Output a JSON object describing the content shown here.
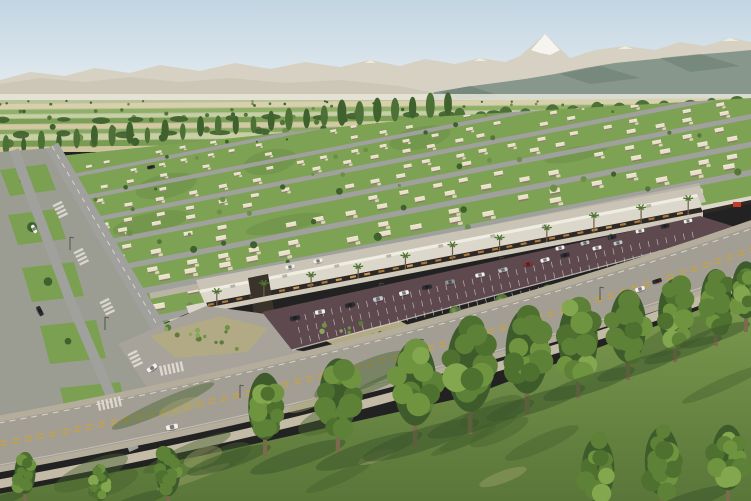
{
  "scene_type": "aerial-render-of-residential-development-with-retail-strip",
  "palette": {
    "sky_top": "#c2d5e2",
    "sky_bottom": "#eaeff2",
    "mountain_far": "#d7d1c3",
    "snow": "#f6f4ef",
    "mountain_right": "#87978b",
    "mountain_right_dark": "#64766a",
    "hills_left": "#cdc7b7",
    "haze": "#e6e6da",
    "farm_base": "#bac29a",
    "farm_s1": "#d8cfac",
    "farm_s2": "#8fb066",
    "farm_s3": "#c6d0a6",
    "farm_s4": "#7d9e55",
    "farm_s5": "#d3c8a2",
    "farm_s6": "#8aa862",
    "farm_s7": "#c9cfa4",
    "farm_s8": "#7a9b52",
    "farm_s9": "#cfc49e",
    "tree_dark": "#3f612e",
    "tree_mid": "#557539",
    "tree_light": "#6e8f49",
    "lawn": "#7da254",
    "lawn_dark": "#5d8140",
    "street": "#a0a09c",
    "house_wall": "#e9e0c8",
    "house_shade": "#7b7260",
    "house_top": "#f3ecd9",
    "house_wing": "#ddd3b9",
    "alley": "#b9b4a6",
    "roof_rear": "#c9c4b6",
    "roof_main": "#dbd7cb",
    "parapet": "#efece2",
    "canopy": "#2e2925",
    "glow": "#bc7f3e",
    "glow_hi": "#e0a45c",
    "portal": "#3a332b",
    "plaza": "#cfc9ba",
    "paved_west": "#a7a29a",
    "bed": "#b2aa85",
    "shrub1": "#5c7a3b",
    "shrub2": "#6f9148",
    "shrub3": "#87a759",
    "shrub_red": "#b86a38",
    "parking": "#5e4a4e",
    "stall": "#ddd5d8",
    "median": "#b1a989",
    "blvd_shoulder": "#b4ad9c",
    "blvd": "#a39e94",
    "lane_yellow": "#c9a23e",
    "line_white": "#e5e1d8",
    "sidewalk": "#c4bba6",
    "verge": "#9b9d92",
    "verge_green": "#79a04e",
    "grass": "#7d9b50",
    "grass_deep": "#5a7639",
    "grass_dark": "#46612f",
    "grass_light": "#a8a771",
    "fg_dark": "#3e5c2b",
    "fg1": "#4e712f",
    "fg2": "#5d8136",
    "fg3": "#6f9440",
    "fg4": "#82a74e",
    "trunk": "#7c6a4e",
    "shadow": "#3a5429",
    "umbrella": "#e0772e",
    "sign_red": "#c23b2c",
    "pole": "#4a4a48",
    "car_white": "#f1f0ec",
    "car_black": "#2c2c32",
    "car_silver": "#c4c8cc",
    "car_gray": "#8e949a",
    "car_red": "#8e2f2f"
  },
  "counts": {
    "farm_scatter": 85,
    "hedge_row1": 18,
    "hedge_row2": 15,
    "poplars": 26,
    "round_row": 13,
    "grass_mottle": 16,
    "grass_patches": 6,
    "res_tree_step": 30
  },
  "residential": {
    "clip_points": "0,162 445,116 751,98 751,202 205,306 120,342 0,378",
    "street_b": [
      190,
      214,
      238,
      263,
      291,
      319,
      349,
      381,
      415,
      449,
      483
    ],
    "slope": 0.195
  },
  "strip": {
    "front": [
      205,
      303,
      700,
      207
    ],
    "columns": 26,
    "glow_dashes": 34,
    "palms": 11,
    "roof_units": 9
  },
  "parking_cars": [
    [
      295,
      318,
      "car_black"
    ],
    [
      320,
      312,
      "car_white"
    ],
    [
      350,
      305,
      "car_black"
    ],
    [
      378,
      299,
      "car_silver"
    ],
    [
      404,
      293,
      "car_white"
    ],
    [
      427,
      287,
      "car_black"
    ],
    [
      450,
      282,
      "car_gray"
    ],
    [
      480,
      275,
      "car_white"
    ],
    [
      503,
      270,
      "car_silver"
    ],
    [
      528,
      264,
      "car_red"
    ],
    [
      545,
      260,
      "car_white"
    ],
    [
      565,
      255,
      "car_black"
    ],
    [
      597,
      248,
      "car_white"
    ],
    [
      618,
      243,
      "car_silver"
    ],
    [
      560,
      248,
      "car_white"
    ],
    [
      585,
      243,
      "car_silver"
    ],
    [
      612,
      237,
      "car_black"
    ],
    [
      640,
      231,
      "car_white"
    ],
    [
      665,
      226,
      "car_black"
    ],
    [
      688,
      221,
      "car_white"
    ]
  ],
  "vehicles": [
    [
      152,
      368,
      -35,
      "car_white"
    ],
    [
      172,
      427,
      -12,
      "car_white"
    ],
    [
      342,
      367,
      -13,
      "car_black"
    ],
    [
      657,
      281,
      -18,
      "car_black"
    ],
    [
      640,
      289,
      -18,
      "car_white"
    ],
    [
      34,
      229,
      63,
      "car_white"
    ],
    [
      40,
      311,
      63,
      "car_black"
    ],
    [
      151,
      167,
      -12,
      "car_black"
    ],
    [
      290,
      267,
      -12,
      "car_white"
    ],
    [
      318,
      261,
      -12,
      "car_white"
    ]
  ],
  "fg_trees": [
    [
      25,
      504,
      50
    ],
    [
      100,
      510,
      44
    ],
    [
      168,
      508,
      58
    ],
    [
      265,
      456,
      80
    ],
    [
      338,
      452,
      90
    ],
    [
      415,
      446,
      102
    ],
    [
      470,
      434,
      110
    ],
    [
      527,
      414,
      102
    ],
    [
      578,
      398,
      94
    ],
    [
      628,
      380,
      87
    ],
    [
      675,
      362,
      80
    ],
    [
      716,
      346,
      74
    ],
    [
      746,
      332,
      68
    ],
    [
      598,
      518,
      78
    ],
    [
      662,
      512,
      82
    ],
    [
      728,
      506,
      78
    ]
  ],
  "median_trees": [
    [
      455,
      318
    ],
    [
      502,
      307
    ],
    [
      548,
      297
    ],
    [
      594,
      287
    ],
    [
      640,
      276
    ]
  ],
  "umbrellas": [
    [
      193,
      317,
      4
    ],
    [
      205,
      312,
      3.5
    ],
    [
      217,
      319,
      4
    ],
    [
      187,
      324,
      3
    ]
  ],
  "zebras": [
    [
      160,
      371,
      -12,
      6
    ],
    [
      98,
      406,
      -12,
      6
    ],
    [
      57,
      203,
      64,
      4
    ],
    [
      78,
      250,
      64,
      4
    ],
    [
      104,
      300,
      64,
      4
    ],
    [
      132,
      352,
      64,
      4
    ]
  ],
  "beds": [
    {
      "cx": 205,
      "cy": 338,
      "rx": 45,
      "ry": 12,
      "n": 14
    },
    {
      "cx": 366,
      "cy": 334,
      "rx": 44,
      "ry": 11,
      "n": 12
    },
    {
      "cx": 540,
      "cy": 296,
      "rx": 165,
      "ry": 10,
      "slope": 0.27,
      "n": 20
    }
  ],
  "verge_quads": [
    [
      0,
      170,
      46,
      26
    ],
    [
      8,
      215,
      48,
      30
    ],
    [
      22,
      268,
      52,
      34
    ],
    [
      40,
      326,
      56,
      38
    ],
    [
      60,
      388,
      60,
      44
    ]
  ],
  "poles": [
    [
      240,
      398
    ],
    [
      420,
      352
    ],
    [
      600,
      300
    ],
    [
      380,
      296
    ],
    [
      500,
      270
    ],
    [
      610,
      247
    ],
    [
      70,
      250
    ],
    [
      105,
      330
    ]
  ]
}
